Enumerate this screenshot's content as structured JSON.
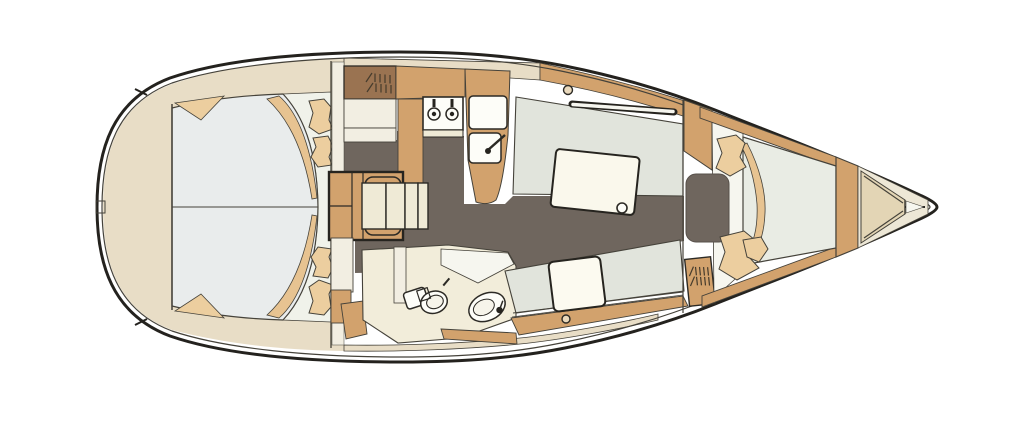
{
  "diagram": {
    "label": "Sailing yacht interior layout floor plan, bow to the right",
    "type": "yacht-floor-plan",
    "orientation": {
      "bow": "right",
      "stern": "left"
    },
    "features": [
      "aft-owner-cabin-double-berth",
      "companionway-steps",
      "louvered-wardrobe-locker",
      "galley-two-burner-stove",
      "galley-twin-sinks",
      "saloon-dinette-with-table",
      "head-with-toilet-and-washbasin",
      "starboard-settee-seat",
      "forward-v-berth-cabin",
      "bow-anchor-locker"
    ]
  },
  "colors": {
    "page": "#ffffff",
    "hull_stroke": "#24221e",
    "thin_line": "#45423a",
    "outline": "#2c2a25",
    "deck_beige": "#e8ddc6",
    "wood": "#d2a26d",
    "soft_tan": "#ecce9f",
    "blanket_tan": "#e7c391",
    "brown": "#9a7351",
    "louver": "#453b2c",
    "floor": "#6f665e",
    "upholstery_gray": "#e1e4dc",
    "aft_mattress": "#e9ecec",
    "pale_zone": "#f0f2ea",
    "fwd_mattress": "#e9ece4",
    "ivory": "#f2eee2",
    "head_floor": "#f2edda",
    "cream": "#efead6",
    "table_cream": "#faf8ec",
    "fixture_white": "#fdfdf8",
    "cushion_white": "#fcfaf0",
    "surround_white": "#f6f6ef",
    "bow_ivory": "#ede7d6",
    "bow_wedge": "#e3d5b5",
    "dark": "#26241f",
    "basin_inner": "#f6f4ea",
    "hatch_fill": "#ead9bc"
  }
}
